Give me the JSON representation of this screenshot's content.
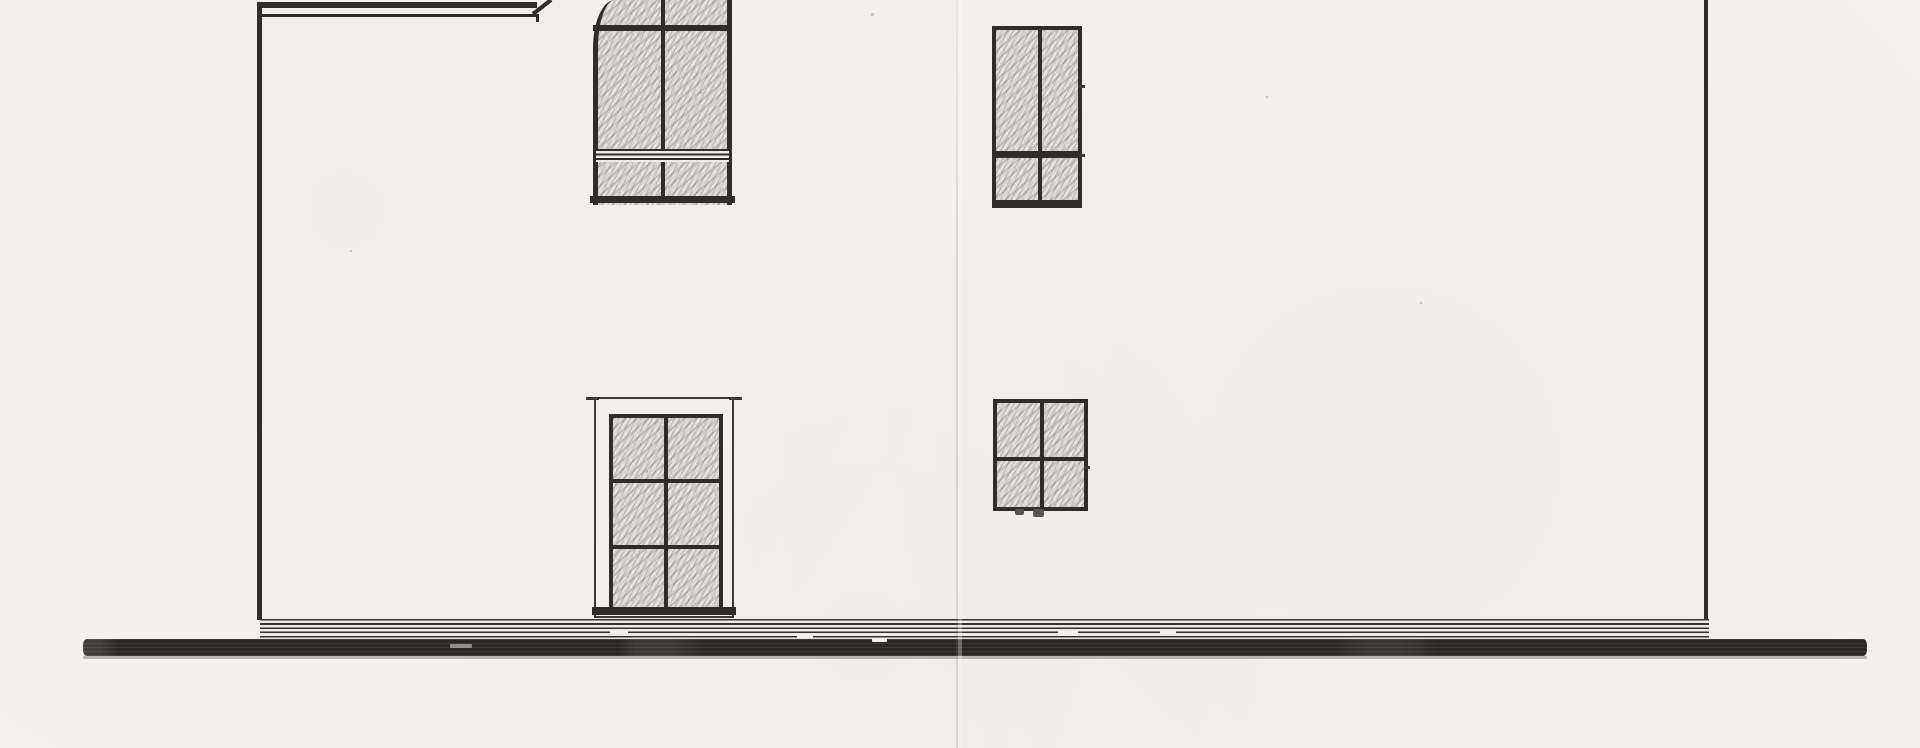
{
  "document": {
    "kind": "scanned architectural drawing",
    "view": "side elevation of a two-story house, pencil and ink on paper, cut off at the top edge",
    "visible_text": []
  },
  "colors": {
    "paper": "#f3f1ec",
    "ink": "#2f2d29",
    "ink_soft": "#3a3834",
    "hatch_base": "#e2e1dc",
    "ground_band": "#2b2926",
    "plinth_line": "#34322e",
    "fold_crease": "#827c70"
  },
  "elements": {
    "left_wing_eave": "double eave line of lower wing at top left with raking roof cut at its right end",
    "left_wall": "vertical wall edge at far left running down to the plinth",
    "right_wall": "vertical wall edge at far right running down to the ground line",
    "upper_left_window": "tall arched window with hatched glazing, arched head cut off by scan edge, triple transom lines near sill, center mullion",
    "upper_right_window": "tall rectangular window, hatched glazing, center mullion, thick transom, projecting sill",
    "lower_left_door": "glazed door in a light surround frame, six hatched panes (2 x 3), heavy sill",
    "lower_right_window": "square four-pane window with hatched glazing and center mullion",
    "plinth": "base course of fine horizontal lines between the two walls",
    "ground_line": "heavy dark ground line spanning nearly the full sheet width with small white scan gaps",
    "fold_crease": "faint vertical paper fold right of center",
    "scan_specks": "small stray pencil/scan specks on the paper"
  }
}
